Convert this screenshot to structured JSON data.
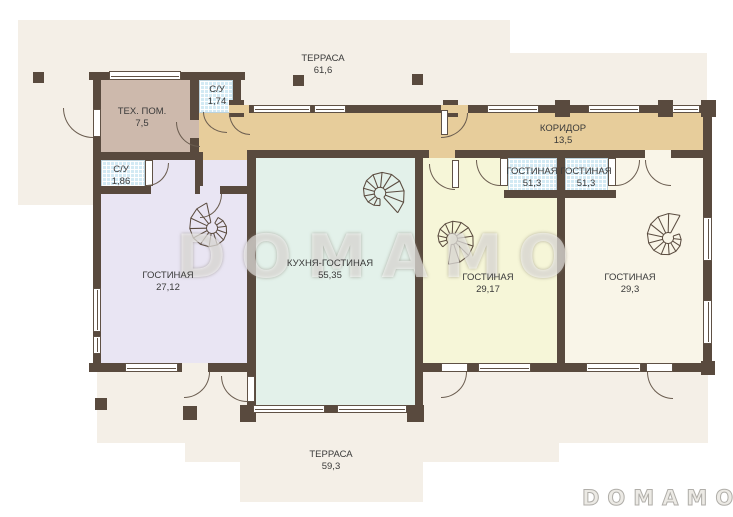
{
  "plan_title": "Floor plan",
  "watermark_text": "DOMAMO",
  "brand_logo_text": "DOMAMO",
  "staircase_count": 4,
  "palette": {
    "wall": "#594a3e",
    "terrace": "#f4efe7",
    "corridor": "#e7cd9b",
    "tech_room": "#cdb9ac",
    "living_left": "#e9e5f3",
    "kitchen_living": "#e3f1ea",
    "living_middle": "#f6f6d8",
    "living_right": "#f9f5e8",
    "bathroom_tile": "#d3eaf4"
  },
  "rooms": [
    {
      "id": "terrace-top",
      "name": "ТЕРРАСА",
      "area": "61,6"
    },
    {
      "id": "tech-room",
      "name": "ТЕХ. ПОМ.",
      "area": "7,5"
    },
    {
      "id": "bathroom-top",
      "name": "С/У",
      "area": "1,74"
    },
    {
      "id": "corridor",
      "name": "КОРИДОР",
      "area": "13,5"
    },
    {
      "id": "bathroom-left",
      "name": "С/У",
      "area": "1,86"
    },
    {
      "id": "small-room-1",
      "name": "ГОСТИНАЯ",
      "area": "51,3"
    },
    {
      "id": "small-room-2",
      "name": "ГОСТИНАЯ",
      "area": "51,3"
    },
    {
      "id": "living-left",
      "name": "ГОСТИНАЯ",
      "area": "27,12"
    },
    {
      "id": "kitchen-living",
      "name": "КУХНЯ-ГОСТИНАЯ",
      "area": "55,35"
    },
    {
      "id": "living-middle",
      "name": "ГОСТИНАЯ",
      "area": "29,17"
    },
    {
      "id": "living-right",
      "name": "ГОСТИНАЯ",
      "area": "29,3"
    },
    {
      "id": "terrace-bottom",
      "name": "ТЕРРАСА",
      "area": "59,3"
    }
  ]
}
